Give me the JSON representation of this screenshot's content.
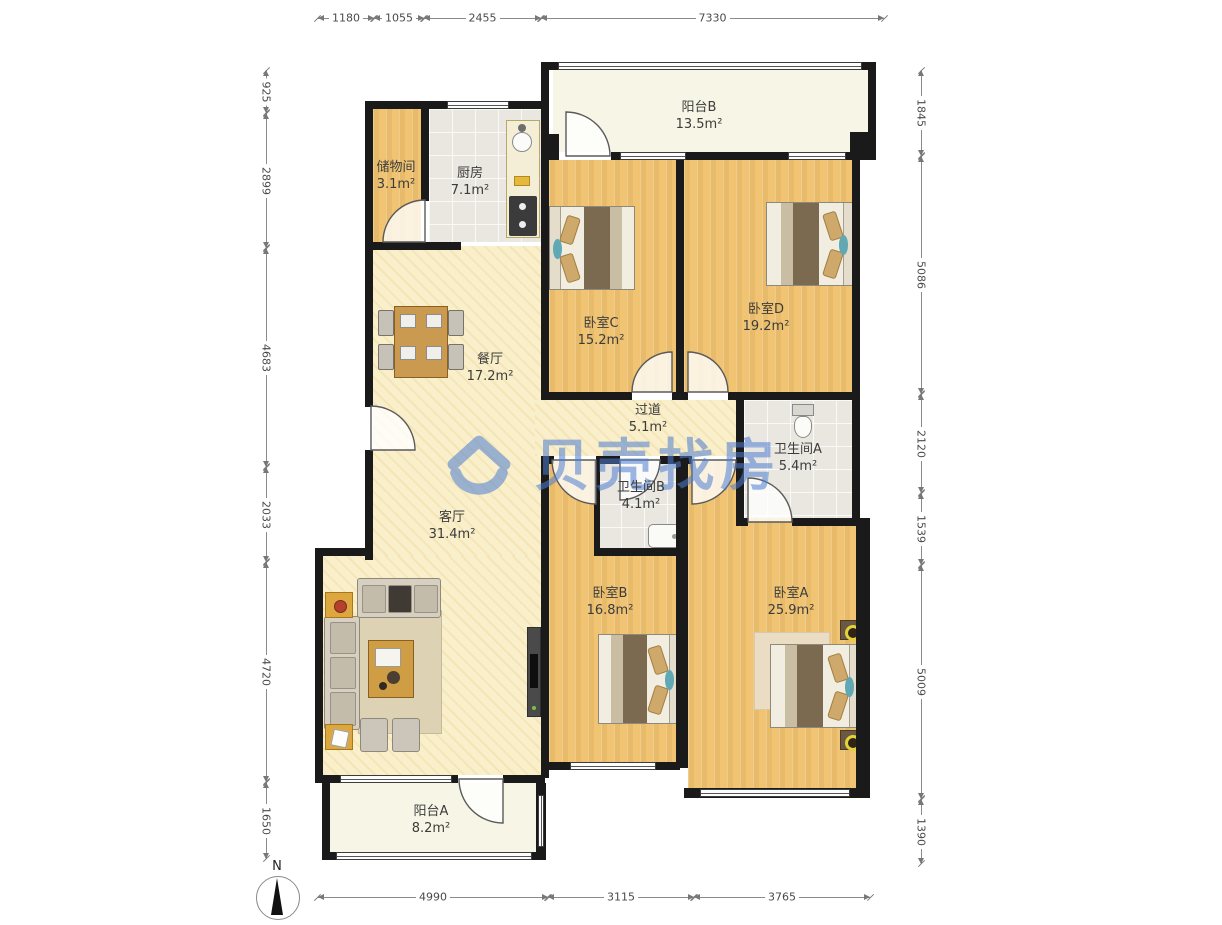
{
  "watermark": {
    "brand": "贝壳找房"
  },
  "compass": {
    "label": "N"
  },
  "rooms": {
    "balcony_b": {
      "name": "阳台B",
      "area": "13.5m²"
    },
    "storage": {
      "name": "储物间",
      "area": "3.1m²"
    },
    "kitchen": {
      "name": "厨房",
      "area": "7.1m²"
    },
    "bedroom_c": {
      "name": "卧室C",
      "area": "15.2m²"
    },
    "bedroom_d": {
      "name": "卧室D",
      "area": "19.2m²"
    },
    "dining": {
      "name": "餐厅",
      "area": "17.2m²"
    },
    "hallway": {
      "name": "过道",
      "area": "5.1m²"
    },
    "bath_a": {
      "name": "卫生间A",
      "area": "5.4m²"
    },
    "bath_b": {
      "name": "卫生间B",
      "area": "4.1m²"
    },
    "living": {
      "name": "客厅",
      "area": "31.4m²"
    },
    "bedroom_b": {
      "name": "卧室B",
      "area": "16.8m²"
    },
    "bedroom_a": {
      "name": "卧室A",
      "area": "25.9m²"
    },
    "balcony_a": {
      "name": "阳台A",
      "area": "8.2m²"
    }
  },
  "dimensions_mm": {
    "top": [
      "1180",
      "1055",
      "2455",
      "7330"
    ],
    "bottom": [
      "4990",
      "3115",
      "3765"
    ],
    "left": [
      "925",
      "2899",
      "4683",
      "2033",
      "4720",
      "1650"
    ],
    "right": [
      "1845",
      "5086",
      "2120",
      "1539",
      "5009",
      "1390"
    ]
  },
  "colors": {
    "wall": "#1a1a1a",
    "wood_floor": "#f0c472",
    "tile_floor": "#e9e7df",
    "warm_floor": "#f9efcb",
    "balcony_floor": "#f7f6e6",
    "watermark_blue": "#4d7ed4"
  }
}
